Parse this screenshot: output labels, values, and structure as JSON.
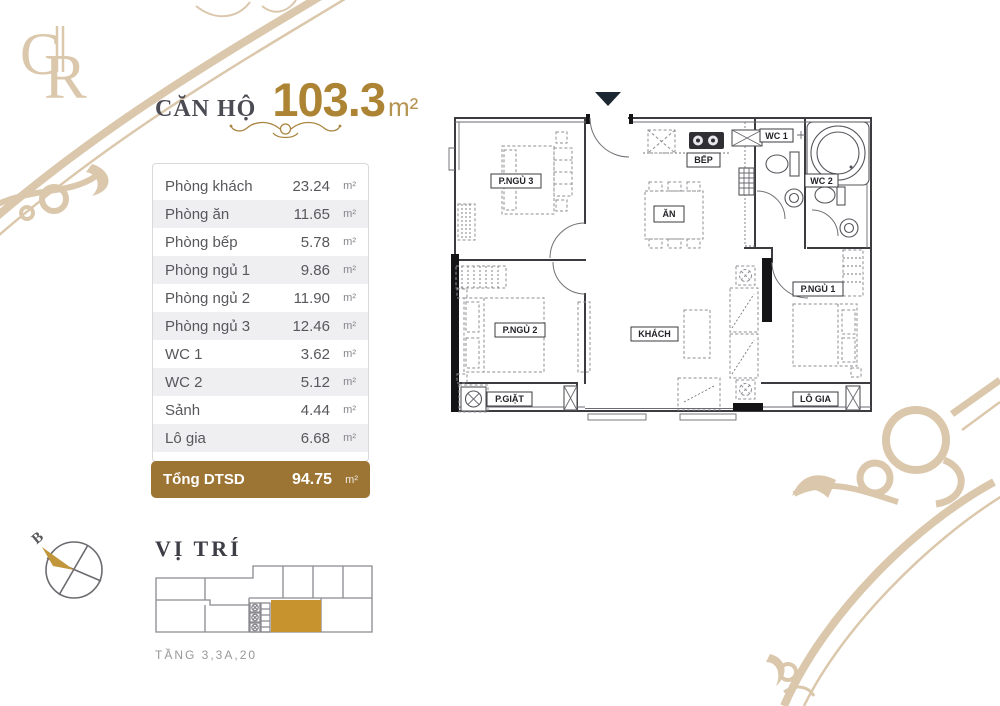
{
  "brand": {
    "monogram_left": "G",
    "monogram_right": "R"
  },
  "header": {
    "title": "CĂN HỘ",
    "area_value": "103.3",
    "area_unit": "m²"
  },
  "area_table": {
    "rows": [
      {
        "label": "Phòng khách",
        "value": "23.24",
        "unit": "m²"
      },
      {
        "label": "Phòng ăn",
        "value": "11.65",
        "unit": "m²"
      },
      {
        "label": "Phòng bếp",
        "value": "5.78",
        "unit": "m²"
      },
      {
        "label": "Phòng ngủ 1",
        "value": "9.86",
        "unit": "m²"
      },
      {
        "label": "Phòng ngủ 2",
        "value": "11.90",
        "unit": "m²"
      },
      {
        "label": "Phòng ngủ 3",
        "value": "12.46",
        "unit": "m²"
      },
      {
        "label": "WC 1",
        "value": "3.62",
        "unit": "m²"
      },
      {
        "label": "WC 2",
        "value": "5.12",
        "unit": "m²"
      },
      {
        "label": "Sảnh",
        "value": "4.44",
        "unit": "m²"
      },
      {
        "label": "Lô gia",
        "value": "6.68",
        "unit": "m²"
      }
    ],
    "total": {
      "label": "Tổng DTSD",
      "value": "94.75",
      "unit": "m²"
    }
  },
  "location": {
    "title": "VỊ TRÍ",
    "caption": "TẦNG 3,3A,20",
    "compass_label": "B"
  },
  "floor_plan": {
    "rooms": {
      "bedroom3": "P.NGỦ 3",
      "kitchen": "BẾP",
      "dining": "ĂN",
      "wc1": "WC 1",
      "wc2": "WC 2",
      "bedroom1": "P.NGỦ 1",
      "bedroom2": "P.NGỦ 2",
      "living": "KHÁCH",
      "laundry": "P.GIẶT",
      "loggia": "LÔ GIA"
    }
  },
  "colors": {
    "accent_gold": "#ac8434",
    "bar_gold": "#9c7434",
    "highlight_gold": "#c6932e",
    "ornament_beige": "#dbc8ac",
    "entrance_navy": "#1c2734"
  }
}
